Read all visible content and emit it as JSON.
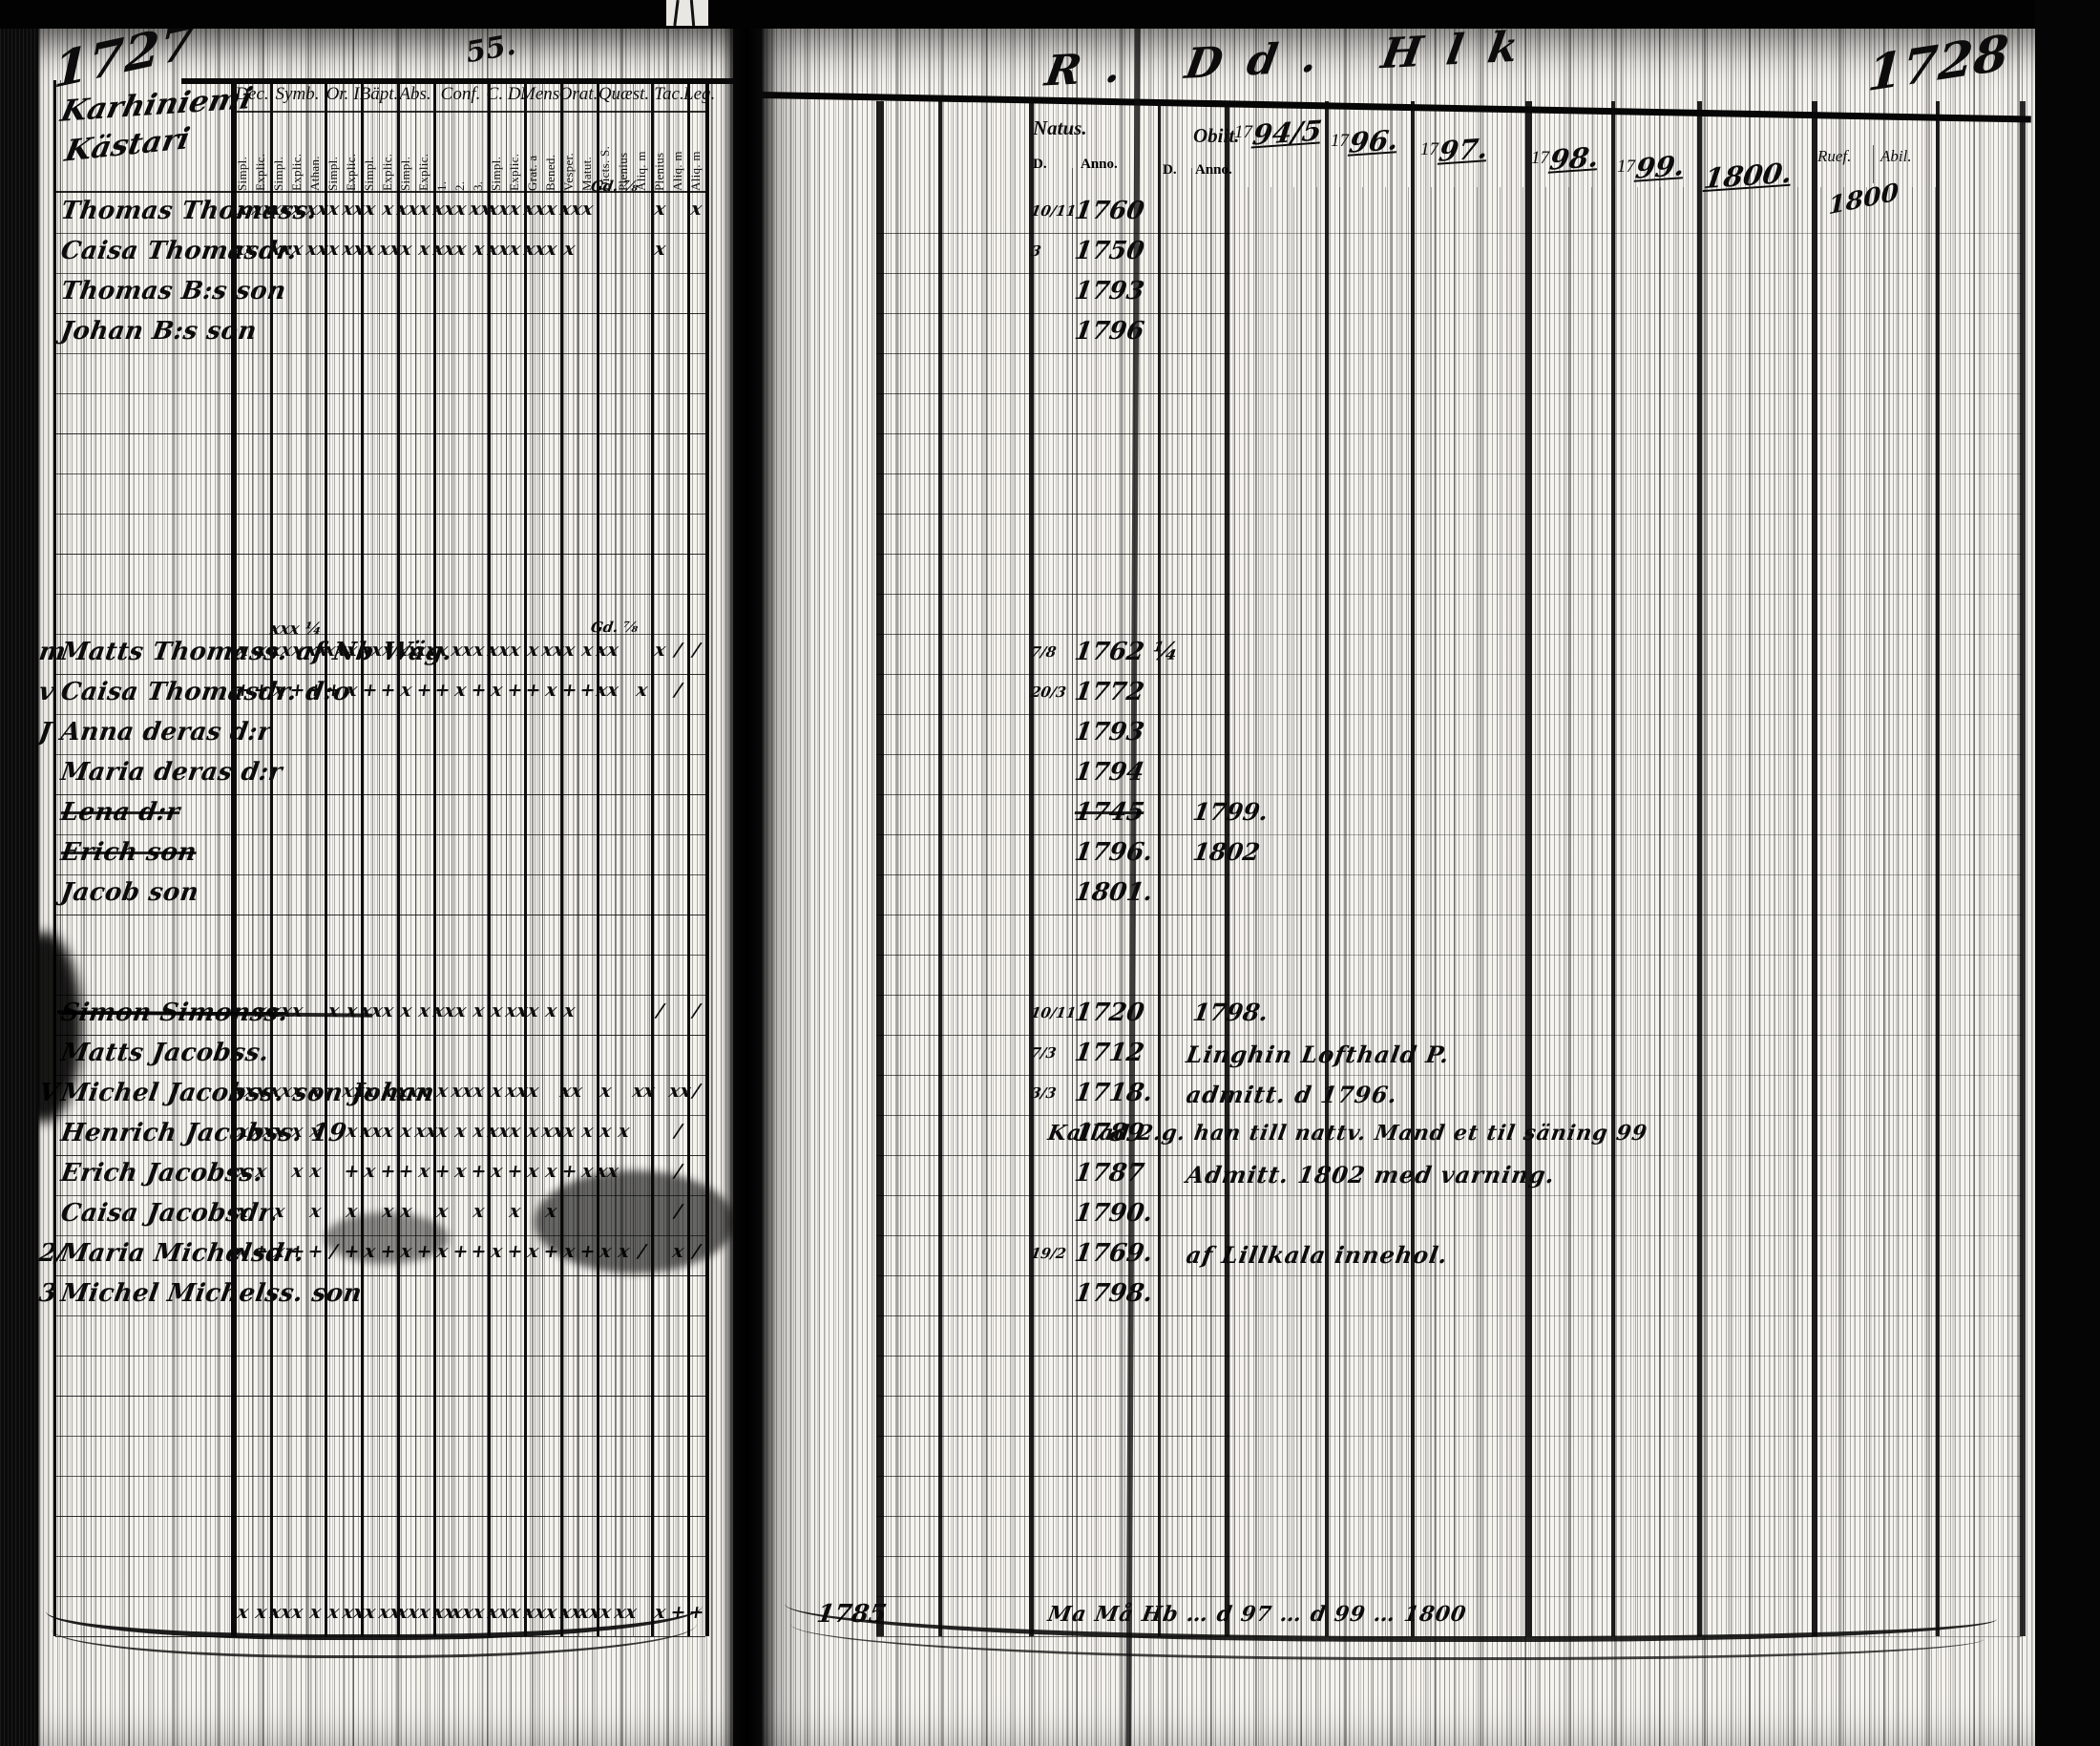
{
  "pages": {
    "left_number": "1727",
    "right_number": "1728",
    "top_scribble": "55.",
    "inspection_marks": "R. Dd. Hlk"
  },
  "left_table": {
    "heading_line1": "Karhiniemi",
    "heading_line2": "Kästari",
    "groups": [
      {
        "label": "Dec.",
        "subs": [
          "Simpl.",
          "Explic."
        ]
      },
      {
        "label": "Symb.",
        "subs": [
          "Simpl.",
          "Explic.",
          "Athan."
        ]
      },
      {
        "label": "Or. I",
        "subs": [
          "Simpl.",
          "Explic."
        ]
      },
      {
        "label": "Bäpt.",
        "subs": [
          "Simpl.",
          "Explic."
        ]
      },
      {
        "label": "Abs.",
        "subs": [
          "Simpl.",
          "Explic."
        ]
      },
      {
        "label": "Conf.",
        "subs": [
          "1.",
          "2.",
          "3."
        ]
      },
      {
        "label": "C. D.",
        "subs": [
          "Simpl.",
          "Explic."
        ]
      },
      {
        "label": "Mens.",
        "subs": [
          "Grat. a",
          "Bened."
        ]
      },
      {
        "label": "Orat.",
        "subs": [
          "Vesper.",
          "Matut."
        ]
      },
      {
        "label": "Quæst.",
        "subs": [
          "Dicts. S.",
          "Plenius",
          "Aliq. m"
        ]
      },
      {
        "label": "Tac.",
        "subs": [
          "Plenius",
          "Aliq. m"
        ]
      },
      {
        "label": "Leg.",
        "subs": [
          "Aliq. m"
        ]
      }
    ]
  },
  "right_table": {
    "natus": {
      "label": "Natus.",
      "sub_d": "D.",
      "sub_anno": "Anno."
    },
    "obiit": {
      "label": "Obiit.",
      "sub_d": "D.",
      "sub_anno": "Anno."
    },
    "years": [
      {
        "print": "17",
        "hand": "94/5"
      },
      {
        "print": "17",
        "hand": "96."
      },
      {
        "print": "17",
        "hand": "97."
      },
      {
        "print": "17",
        "hand": "98."
      },
      {
        "print": "17",
        "hand": "99."
      },
      {
        "print": "",
        "hand": "1800."
      }
    ],
    "last_cols": {
      "col1": "Ruef.",
      "col2": "Abil.",
      "hand": "1800"
    }
  },
  "rows": [
    {
      "i": 1,
      "name": "Thomas Thomass.",
      "annot": "Gd. ⅞",
      "natD": "10/11",
      "nat": "1760",
      "marks": [
        "x",
        "xx",
        "xx",
        "x",
        "xx",
        "x",
        "xx",
        "x",
        "x",
        "xx",
        "x",
        "xx",
        "x",
        "xx",
        "xx",
        "x",
        "xx",
        "x",
        "xx",
        "x",
        "",
        "",
        "",
        "x",
        "",
        "x"
      ]
    },
    {
      "i": 2,
      "name": "Caisa Thomasdr.",
      "natD": "3",
      "nat": "1750",
      "marks": [
        "xx",
        "",
        "xx",
        "x",
        "xx",
        "x",
        "xx",
        "x",
        "xx",
        "x",
        "x",
        "xx",
        "x",
        "x",
        "xx",
        "x",
        "xx",
        "x",
        "x",
        "",
        "",
        "",
        "",
        "x",
        "",
        ""
      ]
    },
    {
      "i": 3,
      "name": "Thomas B:s son",
      "nat": "1793"
    },
    {
      "i": 4,
      "name": "Johan B:s son",
      "nat": "1796"
    },
    {
      "i": 12,
      "name": "Matts Thomass. af Nb Wäg.",
      "margin": "m",
      "over": "xxx ¼",
      "annot": "Gd. ⅞",
      "natD": "7/8",
      "nat": "1762 ¼",
      "marks": [
        "x",
        "x",
        "xx",
        "x",
        "xx",
        "xx",
        "x",
        "xx",
        "x",
        "xx",
        "xx",
        "x",
        "xx",
        "x",
        "xx",
        "x",
        "x",
        "xx",
        "x",
        "x",
        "xx",
        "",
        "",
        "x",
        "/",
        "/"
      ]
    },
    {
      "i": 13,
      "name": "Caisa Thomasdr. d:o",
      "margin": "v",
      "natD": "20/3",
      "nat": "1772",
      "marks": [
        "+",
        "+",
        "x",
        "+",
        "+",
        "+",
        "x",
        "+",
        "+",
        "x",
        "+",
        "+",
        "x",
        "+",
        "x",
        "+",
        "+",
        "x",
        "+",
        "+",
        "xx",
        "",
        "x",
        "",
        "/",
        ""
      ]
    },
    {
      "i": 14,
      "name": "Anna deras d:r",
      "margin": "J",
      "nat": "1793"
    },
    {
      "i": 15,
      "name": "Maria deras d:r",
      "nat": "1794"
    },
    {
      "i": 16,
      "name": "Lena d:r",
      "struck": true,
      "nat": "1745",
      "natStruck": true,
      "ob": "1799."
    },
    {
      "i": 17,
      "name": "Erich son",
      "struck": true,
      "nat": "1796.",
      "ob": "1802"
    },
    {
      "i": 18,
      "name": "Jacob son",
      "nat": "1801."
    },
    {
      "i": 21,
      "name": "Simon Simonss.",
      "struck": true,
      "strikeWide": true,
      "natD": "10/11",
      "nat": "1720",
      "ob": "1798.",
      "marks": [
        "",
        "x",
        "xx",
        "x",
        "",
        "x",
        "x",
        "xx",
        "x",
        "x",
        "x",
        "xx",
        "x",
        "x",
        "x",
        "xx",
        "x",
        "x",
        "x",
        "",
        "",
        "",
        "",
        "/",
        "",
        "/"
      ]
    },
    {
      "i": 22,
      "name": "Matts Jacobss.",
      "natD": "7/3",
      "nat": "1712",
      "note": "Linghin Lofthald P."
    },
    {
      "i": 23,
      "name": "Michel Jacobss. son Johan",
      "margin": "V",
      "natD": "3/3",
      "nat": "1718.",
      "note": "admitt. d 1796.",
      "marks": [
        "xx",
        "x",
        "xx",
        "x",
        "x",
        "",
        "xx",
        "x",
        "x",
        "xx",
        "x",
        "x",
        "xx",
        "x",
        "x",
        "xx",
        "x",
        "",
        "xx",
        "",
        "x",
        "",
        "xx",
        "",
        "xx",
        "/"
      ]
    },
    {
      "i": 24,
      "name": "Henrich Jacobss. 19",
      "nat": "1789",
      "note": "Kallad 2.g. han till nattv. Mand et til säning 99",
      "noteLong": true,
      "marks": [
        "x",
        "xx",
        "x",
        "x",
        "x",
        "",
        "x",
        "xx",
        "x",
        "x",
        "xx",
        "x",
        "x",
        "x",
        "xx",
        "x",
        "x",
        "xx",
        "x",
        "x",
        "x",
        "x",
        "",
        "",
        "/",
        ""
      ]
    },
    {
      "i": 25,
      "name": "Erich Jacobss.",
      "nat": "1787",
      "note": "Admitt. 1802 med varning.",
      "marks": [
        "x",
        "x",
        "",
        "x",
        "x",
        "",
        "+",
        "x",
        "+",
        "+",
        "x",
        "+",
        "x",
        "+",
        "x",
        "+",
        "x",
        "x",
        "+",
        "x",
        "xx",
        "",
        "",
        "",
        "/",
        ""
      ]
    },
    {
      "i": 26,
      "name": "Caisa Jacobsdr.",
      "nat": "1790.",
      "marks": [
        "x",
        "",
        "x",
        "",
        "x",
        "",
        "x",
        "",
        "x",
        "x",
        "",
        "x",
        "",
        "x",
        "",
        "x",
        "",
        "x",
        "",
        "",
        "",
        "",
        "",
        "",
        "/",
        ""
      ]
    },
    {
      "i": 27,
      "name": "Maria Michelsdr.",
      "margin": "2/",
      "natD": "19/2",
      "nat": "1769.",
      "note": "af Lillkala innehol.",
      "marks": [
        "x",
        "+",
        "x",
        "+",
        "+",
        "/",
        "+",
        "x",
        "+",
        "x",
        "+",
        "x",
        "+",
        "+",
        "x",
        "+",
        "x",
        "+",
        "x",
        "+",
        "x",
        "x",
        "/",
        "",
        "x",
        "/"
      ]
    },
    {
      "i": 28,
      "name": "Michel Michelss. son",
      "margin": "3",
      "nat": "1798."
    },
    {
      "i": 36,
      "name": "",
      "nat": "1785",
      "note": "Ma Må Hb … d 97 … d 99 … 1800",
      "noteLong": true,
      "marks": [
        "x",
        "x",
        "xx",
        "x",
        "x",
        "x",
        "xx",
        "x",
        "xx",
        "xx",
        "x",
        "xx",
        "xx",
        "x",
        "xx",
        "x",
        "xx",
        "x",
        "xx",
        "xx",
        "x",
        "xx",
        "",
        "x",
        "+",
        "+"
      ]
    }
  ]
}
